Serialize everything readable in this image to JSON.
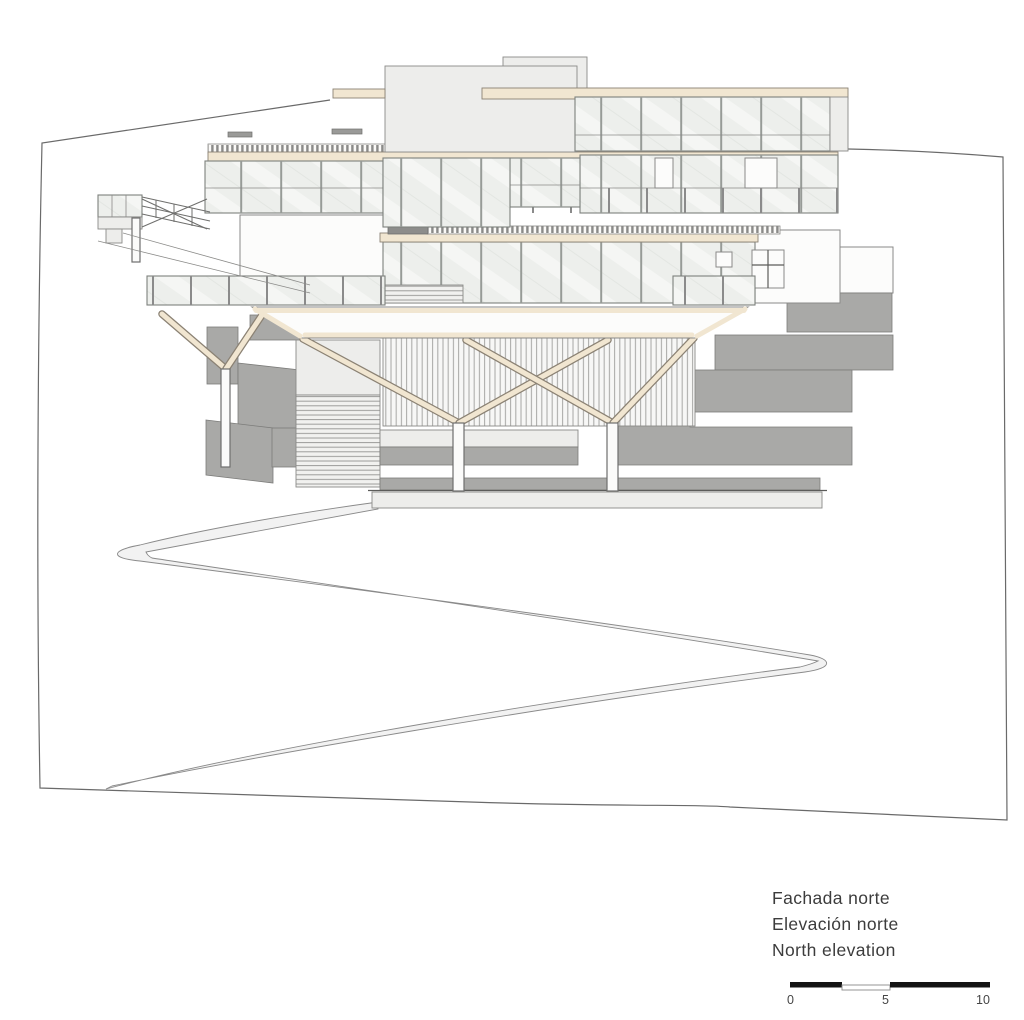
{
  "title_block": {
    "line1": "Fachada norte",
    "line2": "Elevación norte",
    "line3": "North elevation"
  },
  "scale_bar": {
    "start": "0",
    "mid": "5",
    "end": "10"
  },
  "palette": {
    "paper": "#ffffff",
    "line": "#5c5c5a",
    "cream_beam": "#f1e6d1",
    "cream_outline": "#8b8274",
    "glass": "#edefec",
    "light_block": "#ededeb",
    "gray_retaining_wall": "#a9a9a7",
    "path_fill": "#f2f2f2",
    "text": "#3c3c3c"
  }
}
